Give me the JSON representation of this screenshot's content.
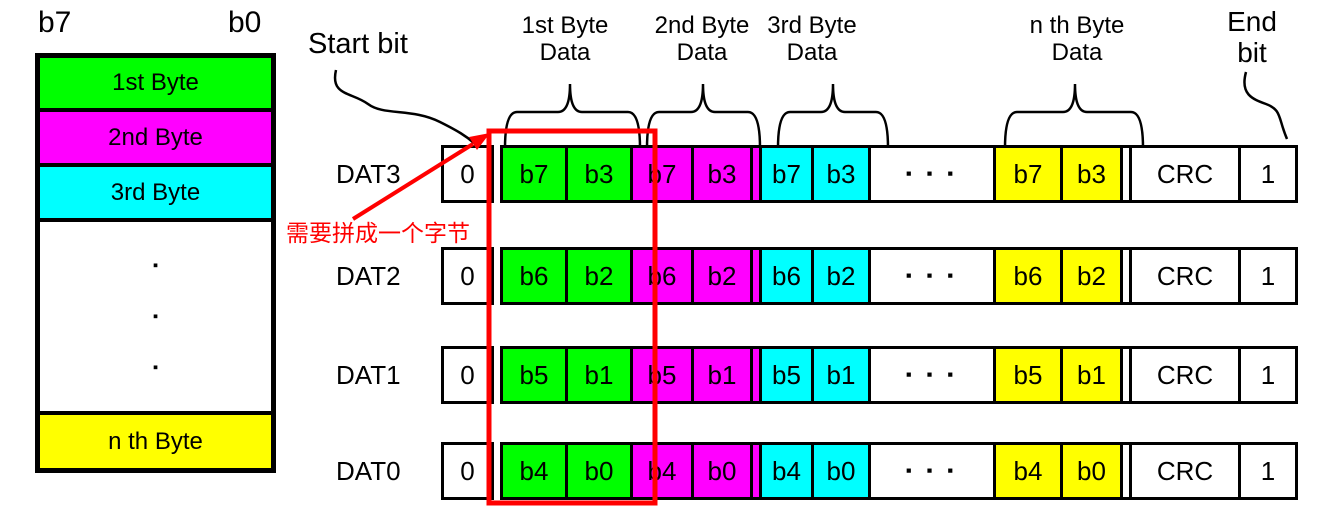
{
  "colors": {
    "green": "#00FF00",
    "magenta": "#FF00FF",
    "cyan": "#00FFFF",
    "yellow": "#FFFF00",
    "red": "#FF0000",
    "black": "#000000"
  },
  "byte_stack": {
    "b7_label": "b7",
    "b0_label": "b0",
    "rows": [
      {
        "label": "1st Byte",
        "color": "#00FF00"
      },
      {
        "label": "2nd Byte",
        "color": "#FF00FF"
      },
      {
        "label": "3rd Byte",
        "color": "#00FFFF"
      },
      {
        "label": "n th Byte",
        "color": "#FFFF00"
      }
    ],
    "dot": "▪"
  },
  "header": {
    "start_bit": "Start bit",
    "byte_groups": [
      {
        "line1": "1st Byte",
        "line2": "Data"
      },
      {
        "line1": "2nd Byte",
        "line2": "Data"
      },
      {
        "line1": "3rd Byte",
        "line2": "Data"
      },
      {
        "line1": "n th Byte",
        "line2": "Data"
      }
    ],
    "end_bit": {
      "line1": "End",
      "line2": "bit"
    }
  },
  "annotation": {
    "text": "需要拼成一个字节"
  },
  "bus": {
    "rows": [
      {
        "label": "DAT3",
        "start_bit": "0",
        "green": [
          "b7",
          "b3"
        ],
        "magenta": [
          "b7",
          "b3"
        ],
        "cyan": [
          "b7",
          "b3"
        ],
        "ellipsis": "▪ ▪ ▪",
        "yellow": [
          "b7",
          "b3"
        ],
        "crc": "CRC",
        "end_bit": "1"
      },
      {
        "label": "DAT2",
        "start_bit": "0",
        "green": [
          "b6",
          "b2"
        ],
        "magenta": [
          "b6",
          "b2"
        ],
        "cyan": [
          "b6",
          "b2"
        ],
        "ellipsis": "▪ ▪ ▪",
        "yellow": [
          "b6",
          "b2"
        ],
        "crc": "CRC",
        "end_bit": "1"
      },
      {
        "label": "DAT1",
        "start_bit": "0",
        "green": [
          "b5",
          "b1"
        ],
        "magenta": [
          "b5",
          "b1"
        ],
        "cyan": [
          "b5",
          "b1"
        ],
        "ellipsis": "▪ ▪ ▪",
        "yellow": [
          "b5",
          "b1"
        ],
        "crc": "CRC",
        "end_bit": "1"
      },
      {
        "label": "DAT0",
        "start_bit": "0",
        "green": [
          "b4",
          "b0"
        ],
        "magenta": [
          "b4",
          "b0"
        ],
        "cyan": [
          "b4",
          "b0"
        ],
        "ellipsis": "▪ ▪ ▪",
        "yellow": [
          "b4",
          "b0"
        ],
        "crc": "CRC",
        "end_bit": "1"
      }
    ]
  }
}
